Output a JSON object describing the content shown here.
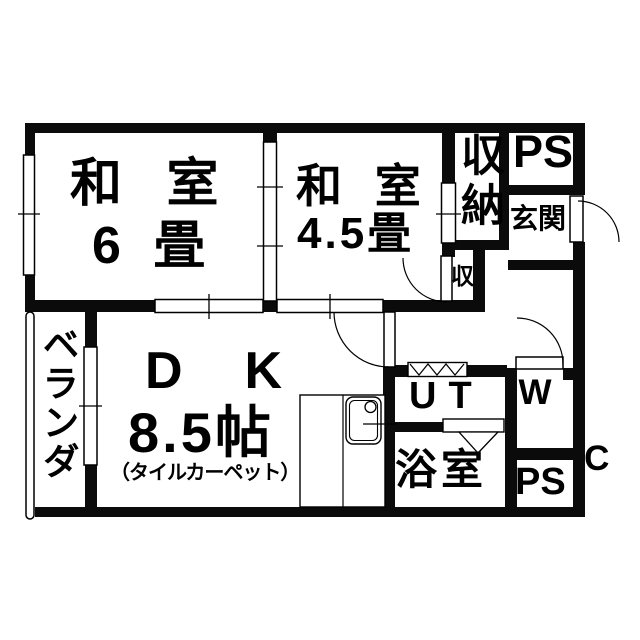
{
  "colors": {
    "wall": "#0b0b0b",
    "line": "#000000",
    "background": "#ffffff"
  },
  "rooms": {
    "washitsu6": {
      "line1": "和 室",
      "line2": "6 畳"
    },
    "washitsu45": {
      "line1": "和 室",
      "line2": "4.5畳"
    },
    "dk": {
      "label": "DK",
      "size": "8.5帖",
      "note": "（タイルカーペット）"
    },
    "storage": {
      "label": "収納"
    },
    "storage_small": {
      "label": "収"
    },
    "genkan": {
      "label": "玄関"
    },
    "ps_top": {
      "label": "PS"
    },
    "ps_bottom": {
      "label": "PS"
    },
    "wc": {
      "line1": "W",
      "line2": "C"
    },
    "ut": {
      "label": "UT"
    },
    "bath": {
      "label": "浴室"
    },
    "veranda": {
      "label": "ベランダ"
    }
  }
}
